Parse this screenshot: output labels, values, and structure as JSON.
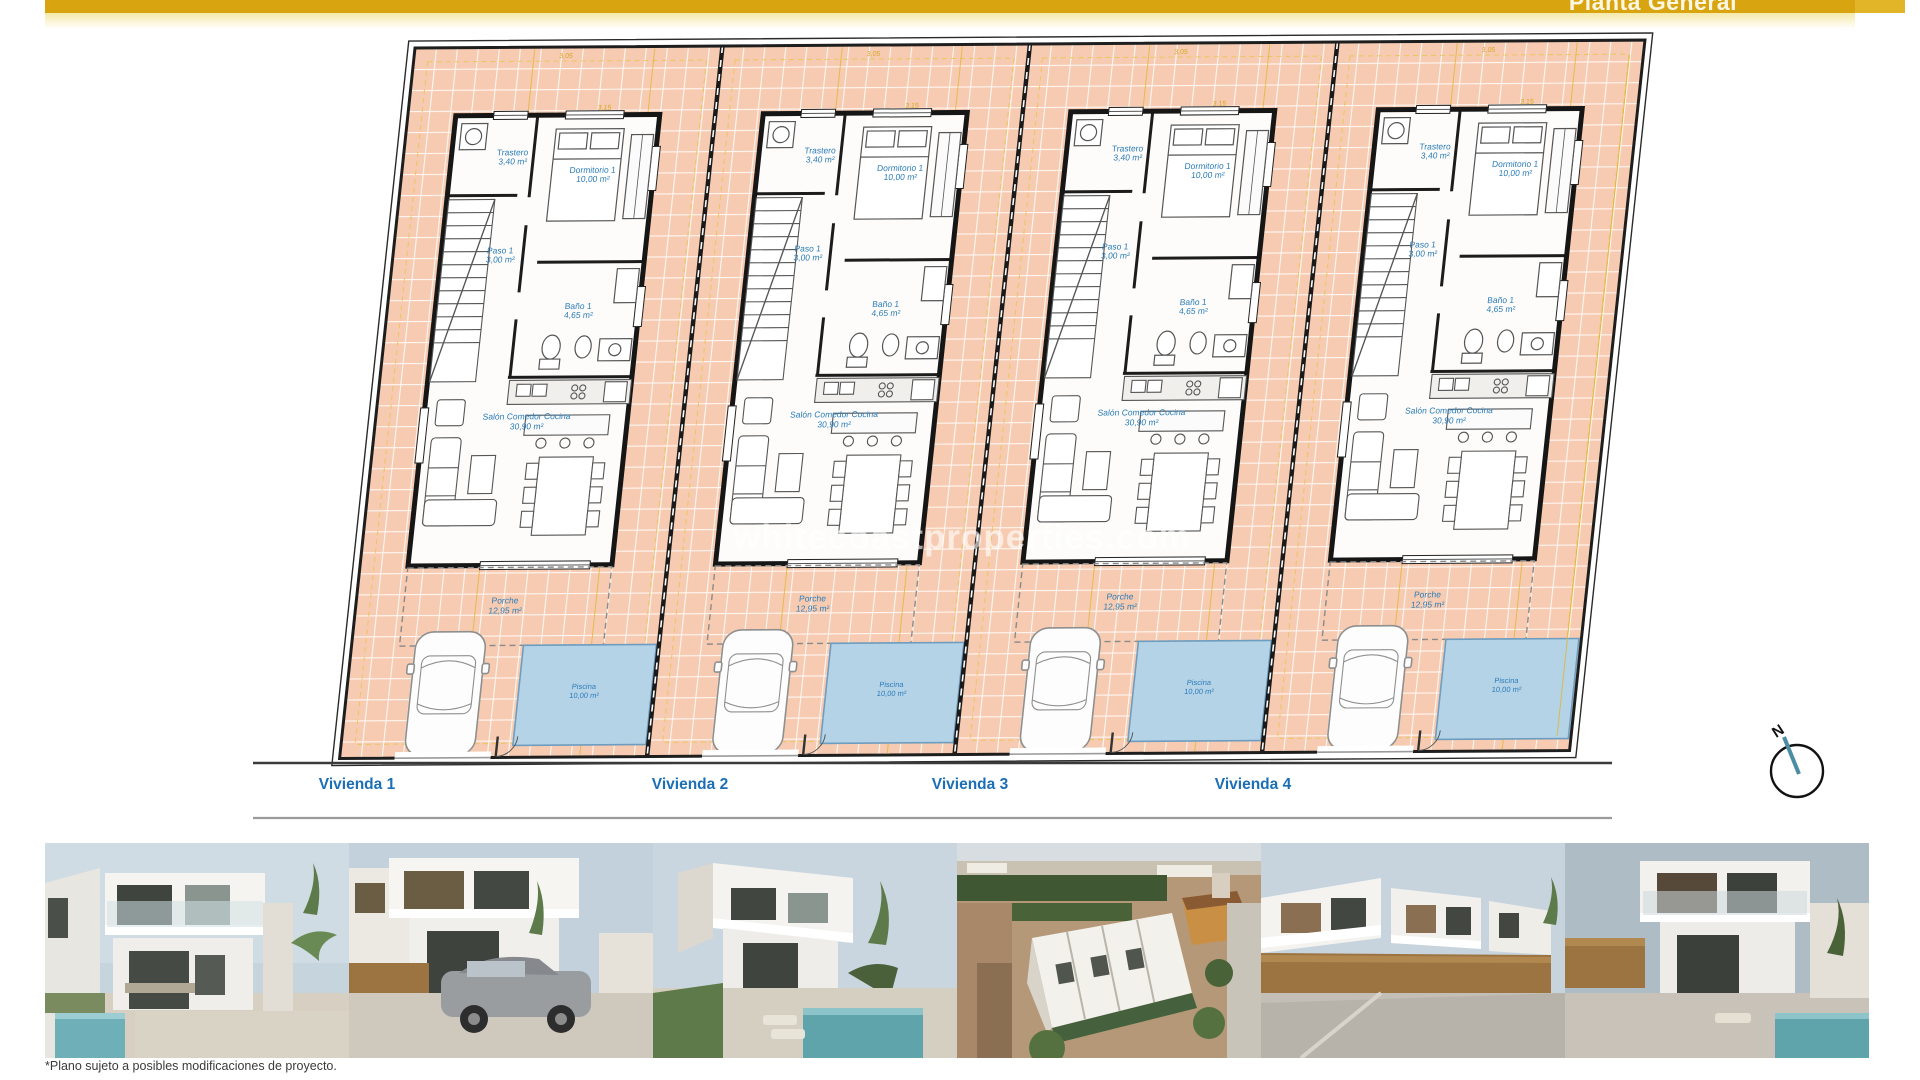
{
  "header": {
    "title": "Planta General"
  },
  "plan": {
    "rooms": [
      {
        "label": "Trastero",
        "area": "3,40 m²"
      },
      {
        "label": "Dormitorio 1",
        "area": "10,00 m²"
      },
      {
        "label": "Paso 1",
        "area": "3,00 m²"
      },
      {
        "label": "Baño 1",
        "area": "4,65 m²"
      },
      {
        "label": "Salón Comedor Cocina",
        "area": "30,90 m²"
      },
      {
        "label": "Porche",
        "area": "12,95 m²"
      },
      {
        "label": "Piscina",
        "area": "10,00 m²"
      }
    ],
    "unit_labels": [
      "Vivienda 1",
      "Vivienda 2",
      "Vivienda 3",
      "Vivienda 4"
    ],
    "dimensions": {
      "top_width": "3,05",
      "bedroom_width": "3,15"
    },
    "compass_label": "N",
    "watermark": "whitecoastproperties.com"
  },
  "footer": {
    "disclaimer": "*Plano sujeto a posibles modificaciones de proyecto.",
    "photos": [
      "villa-front-with-pool",
      "villa-with-grey-car",
      "villa-corner-pool",
      "aerial-development-view",
      "street-row-of-villas",
      "villa-dusk-pool"
    ]
  },
  "colors": {
    "accent_gold": "#d8a511",
    "tile_salmon": "#f6cbb1",
    "pool_blue": "#b5d3e7",
    "label_blue": "#2b7cb9",
    "unit_label_blue": "#1b6fb5",
    "dimension_yellow": "#e0b52c"
  }
}
